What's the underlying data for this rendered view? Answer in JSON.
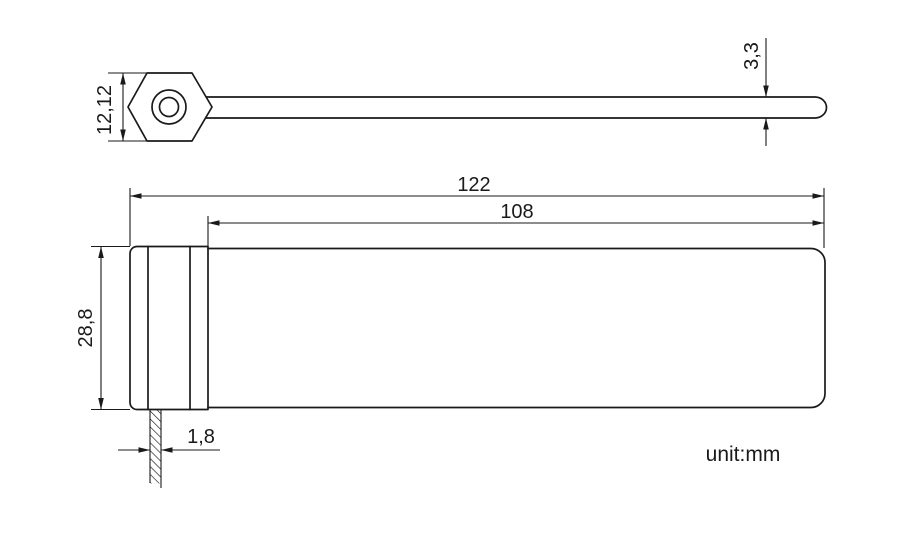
{
  "drawing": {
    "unit_note": "unit:mm",
    "dimensions": {
      "head_height": "12,12",
      "strap_thickness": "3,3",
      "overall_length": "122",
      "strap_length": "108",
      "body_width": "28,8",
      "tail_thickness": "1,8"
    },
    "colors": {
      "line": "#1a1a1a",
      "background": "#ffffff"
    }
  }
}
